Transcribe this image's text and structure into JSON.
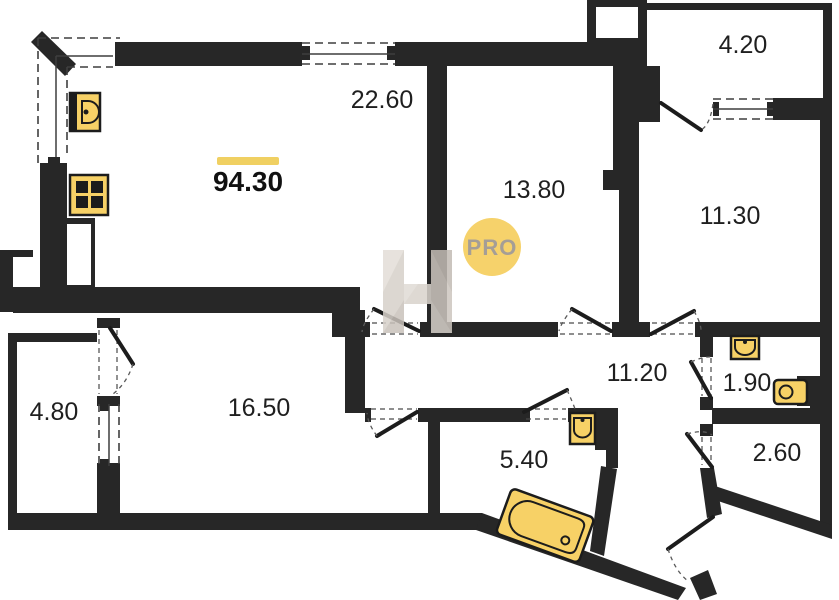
{
  "plan": {
    "total_area": "94.30",
    "watermark": {
      "letter": "H",
      "badge": "PRO"
    },
    "rooms": {
      "living_kitchen": "22.60",
      "room_a": "13.80",
      "room_b": "11.30",
      "balcony": "4.20",
      "room_c": "16.50",
      "loggia": "4.80",
      "hallway": "11.20",
      "wc": "1.90",
      "closet": "2.60",
      "bathroom": "5.40"
    },
    "fixtures": [
      "kitchen-sink",
      "stove",
      "bath-sink",
      "wc-sink",
      "toilet",
      "bathtub"
    ]
  },
  "colors": {
    "wall": "#272727",
    "fixture_fill": "#F7D166",
    "fixture_stroke": "#1C1C1C",
    "accent": "#F0D062",
    "badge_fill": "#F6D26B",
    "badge_text": "#A59E96",
    "label": "#1F1F1F"
  }
}
